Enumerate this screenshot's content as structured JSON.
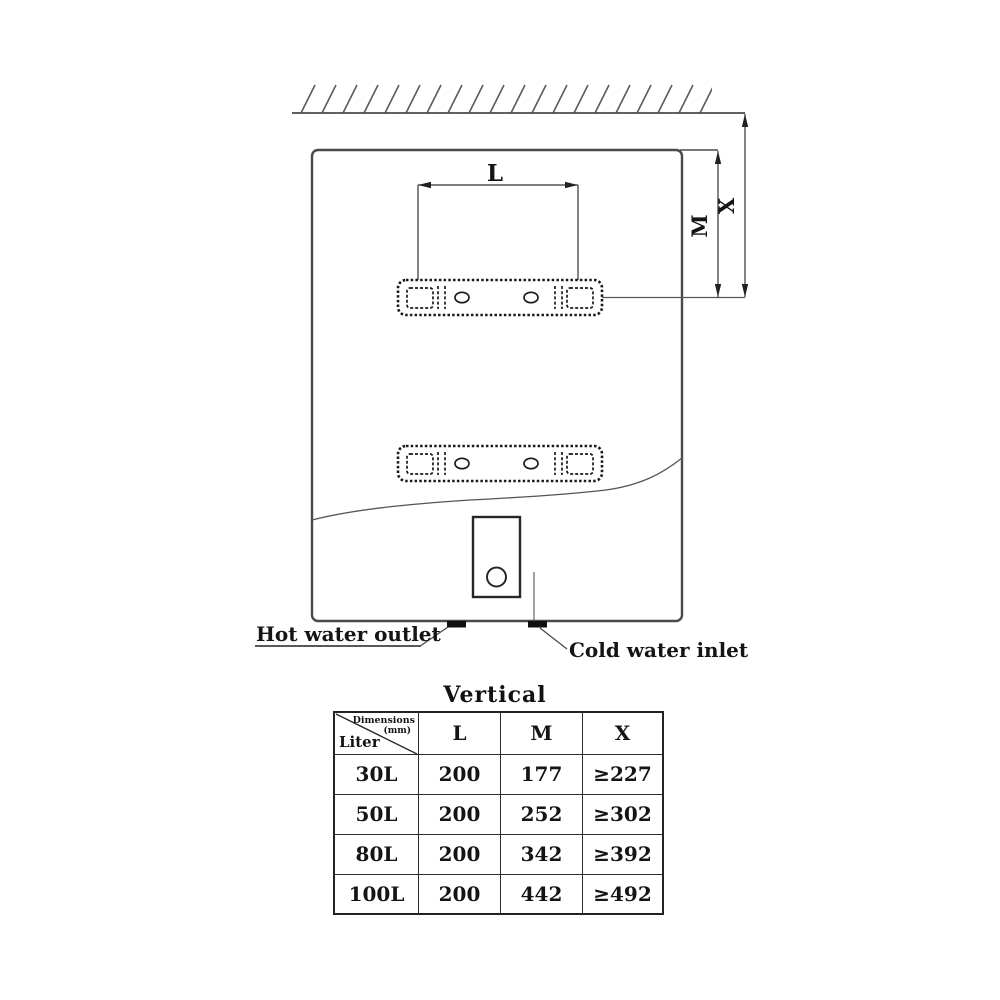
{
  "colors": {
    "line": "#4a4a4a",
    "thin_line": "#555555",
    "bracket_line": "#1a1a1a",
    "text": "#151515",
    "nipple": "#101010",
    "background": "#ffffff"
  },
  "diagram": {
    "dimension_labels": {
      "l": "L",
      "m": "M",
      "x": "X"
    },
    "outlet_label": "Hot water outlet",
    "inlet_label": "Cold water inlet"
  },
  "table": {
    "title": "Vertical",
    "corner": {
      "top": "Dimensions",
      "unit": "(mm)",
      "bottom": "Liter"
    },
    "columns": [
      "L",
      "M",
      "X"
    ],
    "rows": [
      [
        "30L",
        "200",
        "177",
        "≥227"
      ],
      [
        "50L",
        "200",
        "252",
        "≥302"
      ],
      [
        "80L",
        "200",
        "342",
        "≥392"
      ],
      [
        "100L",
        "200",
        "442",
        "≥492"
      ]
    ]
  }
}
